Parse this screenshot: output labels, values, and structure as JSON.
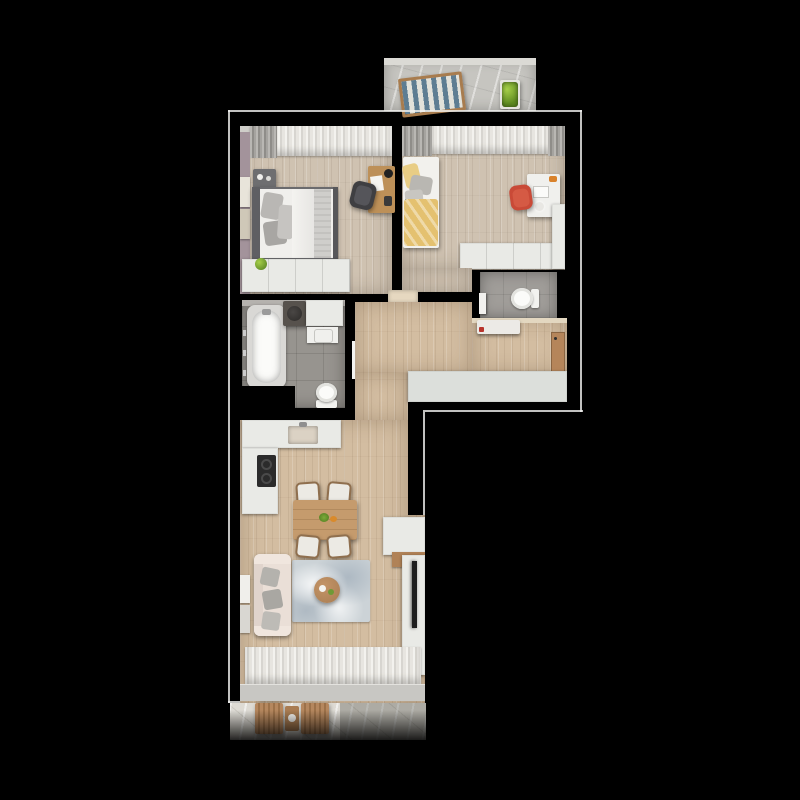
{
  "scene": {
    "type": "3d-rendered-floor-plan-top-view",
    "background_color": "#000000",
    "has_text": false
  },
  "palette": {
    "walls": "#000000",
    "wood_floor_warm": "#d3bda1",
    "wood_floor_cool": "#cfc2b1",
    "bathroom_tile": "#97948f",
    "wc_tile": "#a09d99",
    "white_furniture": "#e9eae6",
    "concrete_balcony": "#c6c5c0",
    "marble_balcony": "#dedbd4",
    "sofa_cream": "#eadfd7",
    "rug_blue_gray": "#ccd3d7",
    "dining_wood": "#c59b6d",
    "entry_door_wood": "#b5855a",
    "accent_red_chair": "#c94a37",
    "accent_yellow_blanket": "#e4c170",
    "plant_green": "#86b13c",
    "lounge_stripe_blue": "#5e7d92",
    "tv_black": "#1e1e1e"
  },
  "rooms": [
    {
      "id": "balcony-top",
      "name": "upper balcony",
      "furniture": [
        "striped lounge chair",
        "planter with green plant"
      ]
    },
    {
      "id": "bedroom-1",
      "name": "master bedroom",
      "furniture": [
        "double bed with gray pillows",
        "dark nightstand with candles",
        "wall art",
        "wood desk with black lamp",
        "black office chair",
        "white wardrobe with plant",
        "gray curtains"
      ]
    },
    {
      "id": "bedroom-2",
      "name": "kids bedroom",
      "furniture": [
        "single bed with yellow blanket",
        "white desk",
        "red chair",
        "white wardrobe",
        "light curtains"
      ]
    },
    {
      "id": "bathroom",
      "name": "bathroom",
      "furniture": [
        "bathtub",
        "dark vanity with round sink",
        "white cabinet",
        "washing machine",
        "toilet"
      ]
    },
    {
      "id": "wc",
      "name": "separate WC",
      "furniture": [
        "toilet",
        "white door"
      ]
    },
    {
      "id": "hallway",
      "name": "entrance hall",
      "furniture": [
        "wooden entry door",
        "built-in wardrobe",
        "shoe bench",
        "bathroom door"
      ]
    },
    {
      "id": "living-kitchen",
      "name": "living room with kitchen",
      "furniture": [
        "L-shaped white kitchen counter",
        "dark cooktop",
        "kitchen sink",
        "wood dining table",
        "4 white dining chairs",
        "cream sofa with gray pillows",
        "blue-gray rug",
        "round wood coffee table",
        "TV cabinet",
        "TV",
        "pouf with cushion",
        "sheer window curtains",
        "leaning wall art"
      ]
    },
    {
      "id": "balcony-bottom",
      "name": "lower balcony",
      "furniture": [
        "two wooden slat chairs",
        "small wooden table with cup"
      ]
    }
  ]
}
